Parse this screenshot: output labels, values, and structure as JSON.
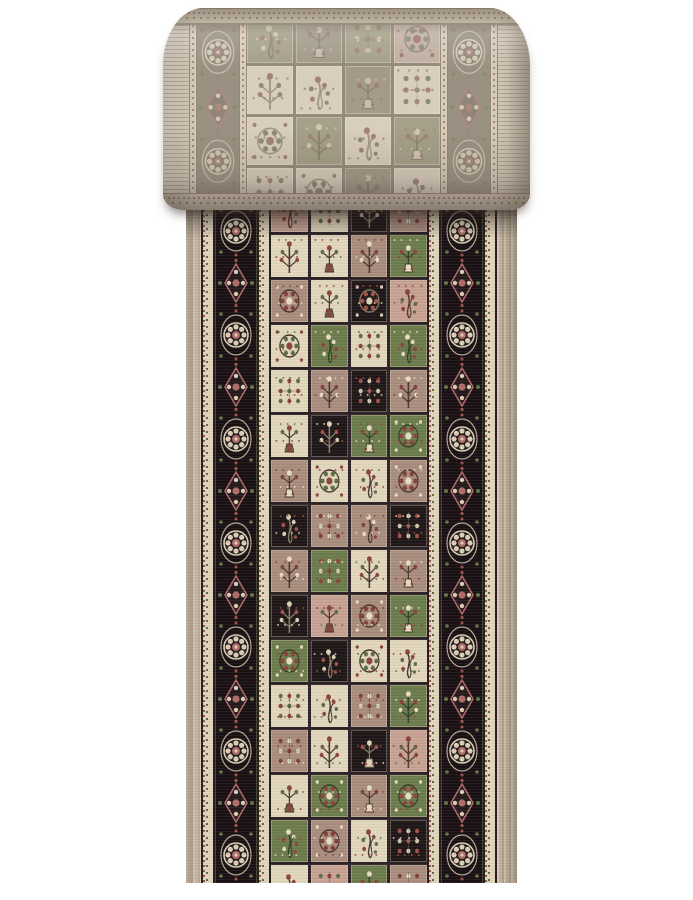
{
  "image": {
    "subject": "Product photo of a beige oriental runner rug, top portion rolled showing muted back, flat front showing panel (garden) design",
    "background": "#ffffff"
  },
  "palette": {
    "background": "#ffffff",
    "selvedge": "#c7b8a2",
    "guard_ivory": "#e0d4bc",
    "guard_dash_red": "#9a544b",
    "guard_dash_green": "#5d6d44",
    "border_ground": "#1a1114",
    "border_rosette_pink": "#b06a6a",
    "border_ivory": "#d9cdb4",
    "border_green": "#667247",
    "grid_line": "#2e2326"
  },
  "runner": {
    "colorways": {
      "I": {
        "ground": "#e2d6bd",
        "primary": "#8a4540",
        "secondary": "#5d6d44",
        "line": "#473731"
      },
      "T": {
        "ground": "#a98d7e",
        "primary": "#e8dcc2",
        "secondary": "#823f3a",
        "line": "#4a362f"
      },
      "G": {
        "ground": "#6d7c4c",
        "primary": "#e8dcc2",
        "secondary": "#8c433c",
        "line": "#33402a"
      },
      "K": {
        "ground": "#1f1718",
        "primary": "#ded2b6",
        "secondary": "#a05149",
        "line": "#8a7d68"
      },
      "R": {
        "ground": "#c7a294",
        "primary": "#8a3f3a",
        "secondary": "#5d6d44",
        "line": "#53352e"
      }
    },
    "field_grid": [
      [
        "R",
        "I",
        "K",
        "T"
      ],
      [
        "I",
        "I",
        "T",
        "G"
      ],
      [
        "T",
        "I",
        "K",
        "R"
      ],
      [
        "I",
        "G",
        "I",
        "G"
      ],
      [
        "I",
        "T",
        "K",
        "T"
      ],
      [
        "I",
        "K",
        "G",
        "G"
      ],
      [
        "T",
        "I",
        "I",
        "T"
      ],
      [
        "K",
        "T",
        "T",
        "K"
      ],
      [
        "T",
        "G",
        "I",
        "T"
      ],
      [
        "K",
        "R",
        "T",
        "G"
      ],
      [
        "G",
        "K",
        "I",
        "I"
      ],
      [
        "I",
        "I",
        "T",
        "G"
      ],
      [
        "T",
        "I",
        "K",
        "R"
      ],
      [
        "I",
        "G",
        "T",
        "G"
      ],
      [
        "G",
        "T",
        "I",
        "K"
      ],
      [
        "I",
        "R",
        "G",
        "T"
      ]
    ],
    "border_medallion_colors": {
      "ivory": "#d9cdb4",
      "pink": "#b06a6a",
      "green": "#667247",
      "inner": "#241a1c",
      "red": "#9a544b"
    },
    "medallions_per_side": 14
  },
  "roll": {
    "colorways": {
      "i": {
        "ground": "#d8cebd",
        "primary": "#a2837c",
        "secondary": "#8f8c72",
        "line": "#a39787"
      },
      "g": {
        "ground": "#a39a89",
        "primary": "#c7bcab",
        "secondary": "#9c7f77",
        "line": "#8e8373"
      },
      "s": {
        "ground": "#a5a089",
        "primary": "#cfc5b2",
        "secondary": "#a2837c",
        "line": "#8f8670"
      },
      "m": {
        "ground": "#c1b0a3",
        "primary": "#a1766f",
        "secondary": "#8f8c72",
        "line": "#97897b"
      }
    },
    "field_grid": [
      [
        "s",
        "g",
        "s",
        "m"
      ],
      [
        "i",
        "i",
        "g",
        "i"
      ],
      [
        "i",
        "s",
        "i",
        "s"
      ],
      [
        "i",
        "i",
        "g",
        "i"
      ]
    ],
    "border_medallion_colors": {
      "ivory": "#d3c8b4",
      "pink": "#ab8a82",
      "green": "#8e8a6d",
      "inner": "#8f8678",
      "red": "#a5857d"
    },
    "medallions_per_side": 4
  }
}
